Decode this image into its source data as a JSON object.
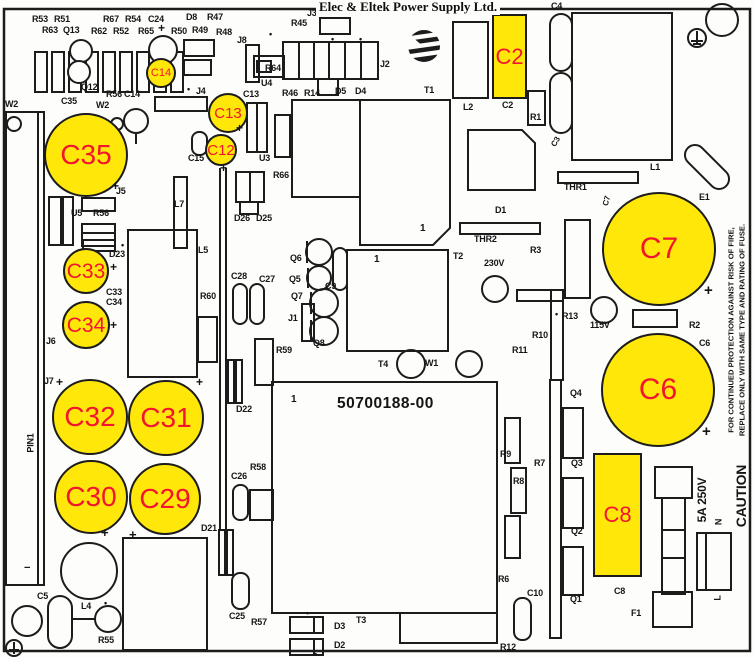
{
  "title": "Elec & Eltek Power Supply Ltd.",
  "part_number": "50700188-00",
  "logo_icon": "eltek-globe-logo",
  "colors": {
    "highlight": "#ffe70a",
    "highlight_label": "#f31430",
    "line": "#1c1c1c",
    "background": "#fdfdfb"
  },
  "caution_text": {
    "line1": "FOR CONTINUED PROTECTION AGAINST RISK OF FIRE,",
    "line2": "REPLACE ONLY WITH SAME TYPE AND RATING OF FUSE."
  },
  "highlights": [
    {
      "id": "C14",
      "shape": "circle",
      "x": 161,
      "y": 73,
      "r": 15,
      "fs": 11
    },
    {
      "id": "C13",
      "shape": "circle",
      "x": 228,
      "y": 113,
      "r": 20,
      "fs": 15
    },
    {
      "id": "C12",
      "shape": "circle",
      "x": 221,
      "y": 150,
      "r": 16,
      "fs": 15
    },
    {
      "id": "C35",
      "shape": "circle",
      "x": 86,
      "y": 155,
      "r": 42,
      "fs": 28
    },
    {
      "id": "C33",
      "shape": "circle",
      "x": 86,
      "y": 271,
      "r": 23,
      "fs": 21
    },
    {
      "id": "C34",
      "shape": "circle",
      "x": 86,
      "y": 325,
      "r": 24,
      "fs": 21
    },
    {
      "id": "C32",
      "shape": "circle",
      "x": 90,
      "y": 417,
      "r": 38,
      "fs": 28
    },
    {
      "id": "C31",
      "shape": "circle",
      "x": 166,
      "y": 418,
      "r": 38,
      "fs": 28
    },
    {
      "id": "C30",
      "shape": "circle",
      "x": 91,
      "y": 497,
      "r": 37,
      "fs": 28
    },
    {
      "id": "C29",
      "shape": "circle",
      "x": 165,
      "y": 499,
      "r": 36,
      "fs": 28
    },
    {
      "id": "C7",
      "shape": "circle",
      "x": 659,
      "y": 249,
      "r": 57,
      "fs": 30
    },
    {
      "id": "C6",
      "shape": "circle",
      "x": 658,
      "y": 390,
      "r": 57,
      "fs": 30
    },
    {
      "id": "C2",
      "shape": "rect",
      "x": 492,
      "y": 14,
      "w": 35,
      "h": 85,
      "fs": 22
    },
    {
      "id": "C8",
      "shape": "rect",
      "x": 593,
      "y": 453,
      "w": 49,
      "h": 124,
      "fs": 22
    }
  ],
  "labels": [
    {
      "t": "R53",
      "x": 32,
      "y": 15
    },
    {
      "t": "R51",
      "x": 54,
      "y": 15
    },
    {
      "t": "R67",
      "x": 103,
      "y": 15
    },
    {
      "t": "R54",
      "x": 125,
      "y": 15
    },
    {
      "t": "C24",
      "x": 148,
      "y": 15
    },
    {
      "t": "D8",
      "x": 186,
      "y": 13
    },
    {
      "t": "R47",
      "x": 207,
      "y": 13
    },
    {
      "t": "+",
      "x": 158,
      "y": 22,
      "fs": 12
    },
    {
      "t": "R63",
      "x": 42,
      "y": 26
    },
    {
      "t": "Q13",
      "x": 63,
      "y": 26
    },
    {
      "t": "R62",
      "x": 91,
      "y": 27
    },
    {
      "t": "R52",
      "x": 113,
      "y": 27
    },
    {
      "t": "R65",
      "x": 138,
      "y": 27
    },
    {
      "t": "R50",
      "x": 171,
      "y": 27
    },
    {
      "t": "R49",
      "x": 192,
      "y": 26
    },
    {
      "t": "R48",
      "x": 216,
      "y": 28
    },
    {
      "t": "J8",
      "x": 237,
      "y": 36
    },
    {
      "t": "Q12",
      "x": 81,
      "y": 83
    },
    {
      "t": "R56",
      "x": 106,
      "y": 90
    },
    {
      "t": "C14",
      "x": 124,
      "y": 90
    },
    {
      "t": "•",
      "x": 187,
      "y": 85,
      "fs": 9
    },
    {
      "t": "J4",
      "x": 196,
      "y": 87
    },
    {
      "t": "C13",
      "x": 243,
      "y": 90
    },
    {
      "t": "W2",
      "x": 5,
      "y": 100
    },
    {
      "t": "C35",
      "x": 61,
      "y": 97
    },
    {
      "t": "W2",
      "x": 96,
      "y": 101
    },
    {
      "t": "J3",
      "x": 307,
      "y": 9
    },
    {
      "t": "•",
      "x": 316,
      "y": 8,
      "fs": 9
    },
    {
      "t": "D7",
      "x": 331,
      "y": 7
    },
    {
      "t": "R45",
      "x": 291,
      "y": 19
    },
    {
      "t": "•",
      "x": 269,
      "y": 30,
      "fs": 9
    },
    {
      "t": "•",
      "x": 331,
      "y": 35,
      "fs": 9
    },
    {
      "t": "•",
      "x": 359,
      "y": 35,
      "fs": 9
    },
    {
      "t": "R64",
      "x": 265,
      "y": 64
    },
    {
      "t": "U4",
      "x": 261,
      "y": 79
    },
    {
      "t": "J2",
      "x": 380,
      "y": 60
    },
    {
      "t": "R46",
      "x": 282,
      "y": 89
    },
    {
      "t": "R14",
      "x": 304,
      "y": 89
    },
    {
      "t": "D5",
      "x": 335,
      "y": 87
    },
    {
      "t": "D4",
      "x": 355,
      "y": 87
    },
    {
      "t": "T1",
      "x": 424,
      "y": 86
    },
    {
      "t": "L2",
      "x": 463,
      "y": 103
    },
    {
      "t": "C2",
      "x": 502,
      "y": 101
    },
    {
      "t": "R1",
      "x": 530,
      "y": 113
    },
    {
      "t": "C4",
      "x": 551,
      "y": 2
    },
    {
      "t": "C3",
      "x": 556,
      "y": 142,
      "fs": 8,
      "rot": -60
    },
    {
      "t": "C15",
      "x": 188,
      "y": 154
    },
    {
      "t": "U3",
      "x": 259,
      "y": 154
    },
    {
      "t": "R66",
      "x": 273,
      "y": 171
    },
    {
      "t": "+",
      "x": 236,
      "y": 122,
      "fs": 12
    },
    {
      "t": "+",
      "x": 220,
      "y": 162,
      "fs": 12
    },
    {
      "t": "D26",
      "x": 234,
      "y": 214
    },
    {
      "t": "D25",
      "x": 256,
      "y": 214
    },
    {
      "t": "U5",
      "x": 71,
      "y": 209
    },
    {
      "t": "R56",
      "x": 93,
      "y": 209
    },
    {
      "t": "D23",
      "x": 109,
      "y": 250
    },
    {
      "t": "•",
      "x": 121,
      "y": 241,
      "fs": 9
    },
    {
      "t": "+",
      "x": 112,
      "y": 180,
      "fs": 12
    },
    {
      "t": "J5",
      "x": 116,
      "y": 187
    },
    {
      "t": "L7",
      "x": 174,
      "y": 200
    },
    {
      "t": "C33",
      "x": 106,
      "y": 288
    },
    {
      "t": "C34",
      "x": 106,
      "y": 298
    },
    {
      "t": "+",
      "x": 110,
      "y": 261,
      "fs": 12
    },
    {
      "t": "+",
      "x": 110,
      "y": 319,
      "fs": 12
    },
    {
      "t": "J6",
      "x": 46,
      "y": 337
    },
    {
      "t": "J7",
      "x": 44,
      "y": 377
    },
    {
      "t": "+",
      "x": 56,
      "y": 376,
      "fs": 12
    },
    {
      "t": "+",
      "x": 196,
      "y": 376,
      "fs": 12
    },
    {
      "t": "+",
      "x": 101,
      "y": 526,
      "fs": 13
    },
    {
      "t": "+",
      "x": 129,
      "y": 528,
      "fs": 13
    },
    {
      "t": "PIN1",
      "x": 31,
      "y": 443,
      "rot": -90
    },
    {
      "t": "−",
      "x": 24,
      "y": 563,
      "fs": 11
    },
    {
      "t": "L5",
      "x": 198,
      "y": 246
    },
    {
      "t": "R60",
      "x": 200,
      "y": 292
    },
    {
      "t": "C28",
      "x": 231,
      "y": 272
    },
    {
      "t": "C27",
      "x": 259,
      "y": 275
    },
    {
      "t": "R59",
      "x": 276,
      "y": 346
    },
    {
      "t": "Q6",
      "x": 290,
      "y": 254
    },
    {
      "t": "Q5",
      "x": 289,
      "y": 275
    },
    {
      "t": "Q7",
      "x": 291,
      "y": 292
    },
    {
      "t": "J1",
      "x": 288,
      "y": 314
    },
    {
      "t": "Q8",
      "x": 313,
      "y": 339
    },
    {
      "t": "C9",
      "x": 325,
      "y": 282
    },
    {
      "t": "1",
      "x": 420,
      "y": 224,
      "fs": 10
    },
    {
      "t": "1",
      "x": 374,
      "y": 255,
      "fs": 10
    },
    {
      "t": "T2",
      "x": 453,
      "y": 252
    },
    {
      "t": "D1",
      "x": 495,
      "y": 206
    },
    {
      "t": "THR2",
      "x": 474,
      "y": 235
    },
    {
      "t": "THR1",
      "x": 564,
      "y": 183
    },
    {
      "t": "L1",
      "x": 650,
      "y": 163
    },
    {
      "t": "E1",
      "x": 699,
      "y": 193
    },
    {
      "t": "C7",
      "x": 607,
      "y": 201,
      "rot": -75,
      "fs": 8
    },
    {
      "t": "R3",
      "x": 530,
      "y": 246
    },
    {
      "t": "230V",
      "x": 484,
      "y": 259
    },
    {
      "t": "•",
      "x": 555,
      "y": 310,
      "fs": 9
    },
    {
      "t": "R13",
      "x": 562,
      "y": 312
    },
    {
      "t": "115V",
      "x": 590,
      "y": 321
    },
    {
      "t": "R2",
      "x": 689,
      "y": 321
    },
    {
      "t": "C6",
      "x": 699,
      "y": 339
    },
    {
      "t": "+",
      "x": 704,
      "y": 283,
      "fs": 15
    },
    {
      "t": "+",
      "x": 702,
      "y": 424,
      "fs": 15
    },
    {
      "t": "R10",
      "x": 532,
      "y": 331
    },
    {
      "t": "R11",
      "x": 512,
      "y": 346
    },
    {
      "t": "T4",
      "x": 378,
      "y": 360
    },
    {
      "t": "W1",
      "x": 425,
      "y": 359
    },
    {
      "t": "1",
      "x": 291,
      "y": 395,
      "fs": 10
    },
    {
      "t": "D22",
      "x": 236,
      "y": 405
    },
    {
      "t": "C26",
      "x": 231,
      "y": 472
    },
    {
      "t": "R58",
      "x": 250,
      "y": 463
    },
    {
      "t": "D21",
      "x": 201,
      "y": 524
    },
    {
      "t": "C25",
      "x": 229,
      "y": 612
    },
    {
      "t": "R57",
      "x": 251,
      "y": 618
    },
    {
      "t": "D3",
      "x": 334,
      "y": 622
    },
    {
      "t": "D2",
      "x": 334,
      "y": 641
    },
    {
      "t": "T3",
      "x": 356,
      "y": 616
    },
    {
      "t": "•",
      "x": 306,
      "y": 609,
      "fs": 9
    },
    {
      "t": "•",
      "x": 314,
      "y": 650,
      "fs": 9
    },
    {
      "t": "C5",
      "x": 37,
      "y": 592
    },
    {
      "t": "L4",
      "x": 81,
      "y": 602
    },
    {
      "t": "•",
      "x": 104,
      "y": 599,
      "fs": 9
    },
    {
      "t": "R55",
      "x": 98,
      "y": 636
    },
    {
      "t": "R9",
      "x": 500,
      "y": 450
    },
    {
      "t": "R7",
      "x": 534,
      "y": 459
    },
    {
      "t": "R8",
      "x": 513,
      "y": 477
    },
    {
      "t": "R6",
      "x": 498,
      "y": 575
    },
    {
      "t": "C10",
      "x": 527,
      "y": 589
    },
    {
      "t": "R12",
      "x": 500,
      "y": 643
    },
    {
      "t": "Q4",
      "x": 570,
      "y": 389
    },
    {
      "t": "Q3",
      "x": 571,
      "y": 459
    },
    {
      "t": "Q2",
      "x": 571,
      "y": 527
    },
    {
      "t": "Q1",
      "x": 570,
      "y": 595
    },
    {
      "t": "C8",
      "x": 614,
      "y": 587
    },
    {
      "t": "F1",
      "x": 631,
      "y": 609
    },
    {
      "t": "5A 250V",
      "x": 702,
      "y": 500,
      "rot": -90,
      "fs": 12
    },
    {
      "t": "N",
      "x": 719,
      "y": 522,
      "rot": -90,
      "fs": 9
    },
    {
      "t": "CAUTION",
      "x": 741,
      "y": 496,
      "rot": -90,
      "fs": 14
    },
    {
      "t": "L",
      "x": 718,
      "y": 598,
      "rot": -90,
      "fs": 9
    }
  ]
}
